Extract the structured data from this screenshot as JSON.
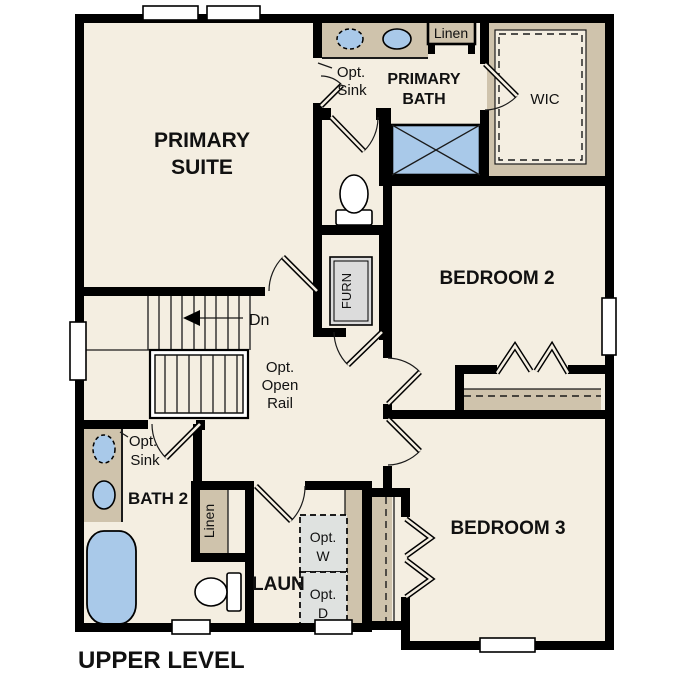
{
  "title": {
    "text": "UPPER LEVEL"
  },
  "rooms": {
    "primary_suite": {
      "line1": "PRIMARY",
      "line2": "SUITE"
    },
    "primary_bath": {
      "line1": "PRIMARY",
      "line2": "BATH"
    },
    "wic": {
      "label": "WIC"
    },
    "bedroom2": {
      "label": "BEDROOM 2"
    },
    "bedroom3": {
      "label": "BEDROOM 3"
    },
    "bath2": {
      "label": "BATH 2"
    },
    "laundry": {
      "label": "LAUN"
    }
  },
  "closets": {
    "linen_bath": {
      "label": "Linen"
    },
    "linen_hall": {
      "label": "Linen"
    }
  },
  "annotations": {
    "down": {
      "label": "Dn"
    },
    "open_rail": {
      "line1": "Opt.",
      "line2": "Open",
      "line3": "Rail"
    },
    "opt_sink_primary": {
      "line1": "Opt.",
      "line2": "Sink"
    },
    "opt_sink_bath2": {
      "line1": "Opt.",
      "line2": "Sink"
    },
    "opt_washer": {
      "line1": "Opt.",
      "line2": "W"
    },
    "opt_dryer": {
      "line1": "Opt.",
      "line2": "D"
    },
    "furnace": {
      "label": "FURN"
    }
  },
  "colors": {
    "floor": "#f4eee1",
    "counter_tan": "#cfc3ac",
    "fixture_blue": "#a9c9e9",
    "wall_black": "#000000",
    "appliance_grey": "#dfe2e0",
    "furnace_grey": "#dcdcdc",
    "background": "#ffffff"
  }
}
